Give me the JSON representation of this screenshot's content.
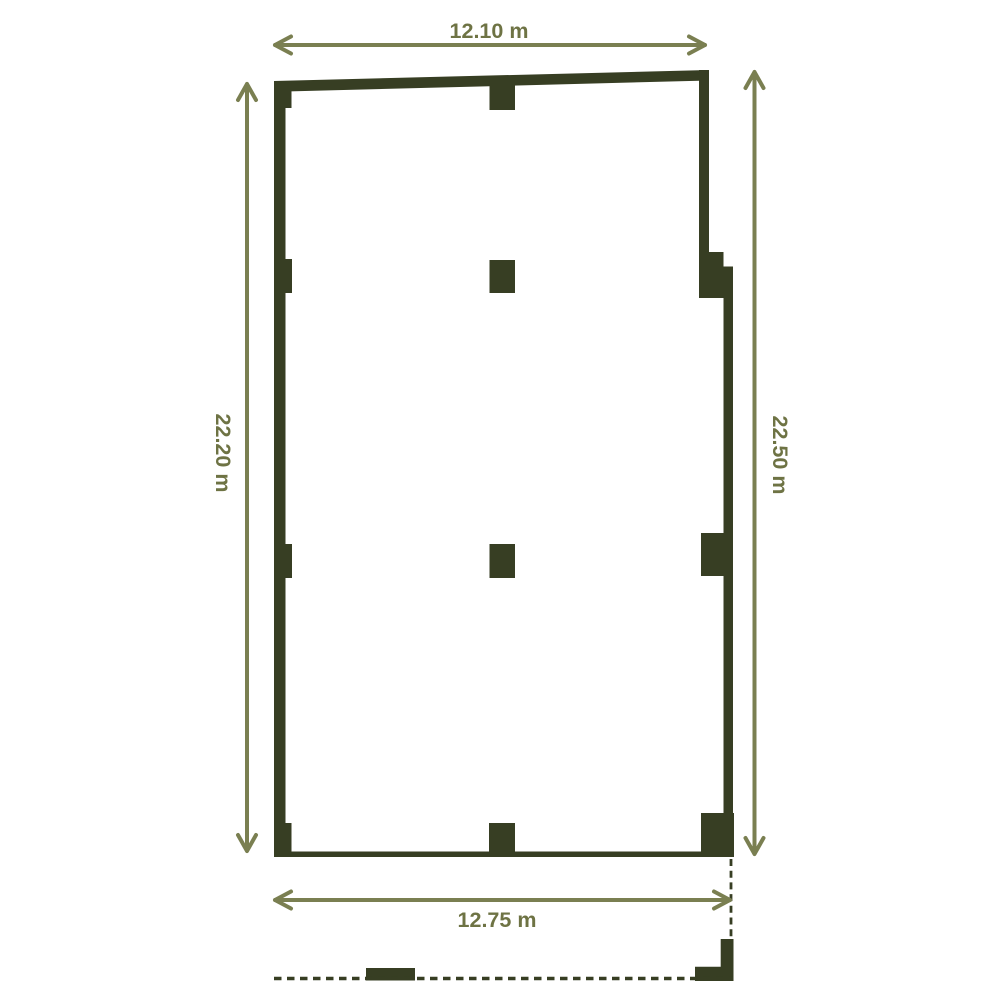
{
  "floor_plan": {
    "dimensions": {
      "top": {
        "label": "12.10 m",
        "value": 12.1,
        "unit": "m"
      },
      "left": {
        "label": "22.20 m",
        "value": 22.2,
        "unit": "m"
      },
      "right": {
        "label": "22.50 m",
        "value": 22.5,
        "unit": "m"
      },
      "bottom": {
        "label": "12.75 m",
        "value": 12.75,
        "unit": "m"
      }
    },
    "colors": {
      "wall": "#373e23",
      "dimension_line": "#7a7f51",
      "dimension_text": "#6e7344",
      "background": "#ffffff"
    }
  }
}
